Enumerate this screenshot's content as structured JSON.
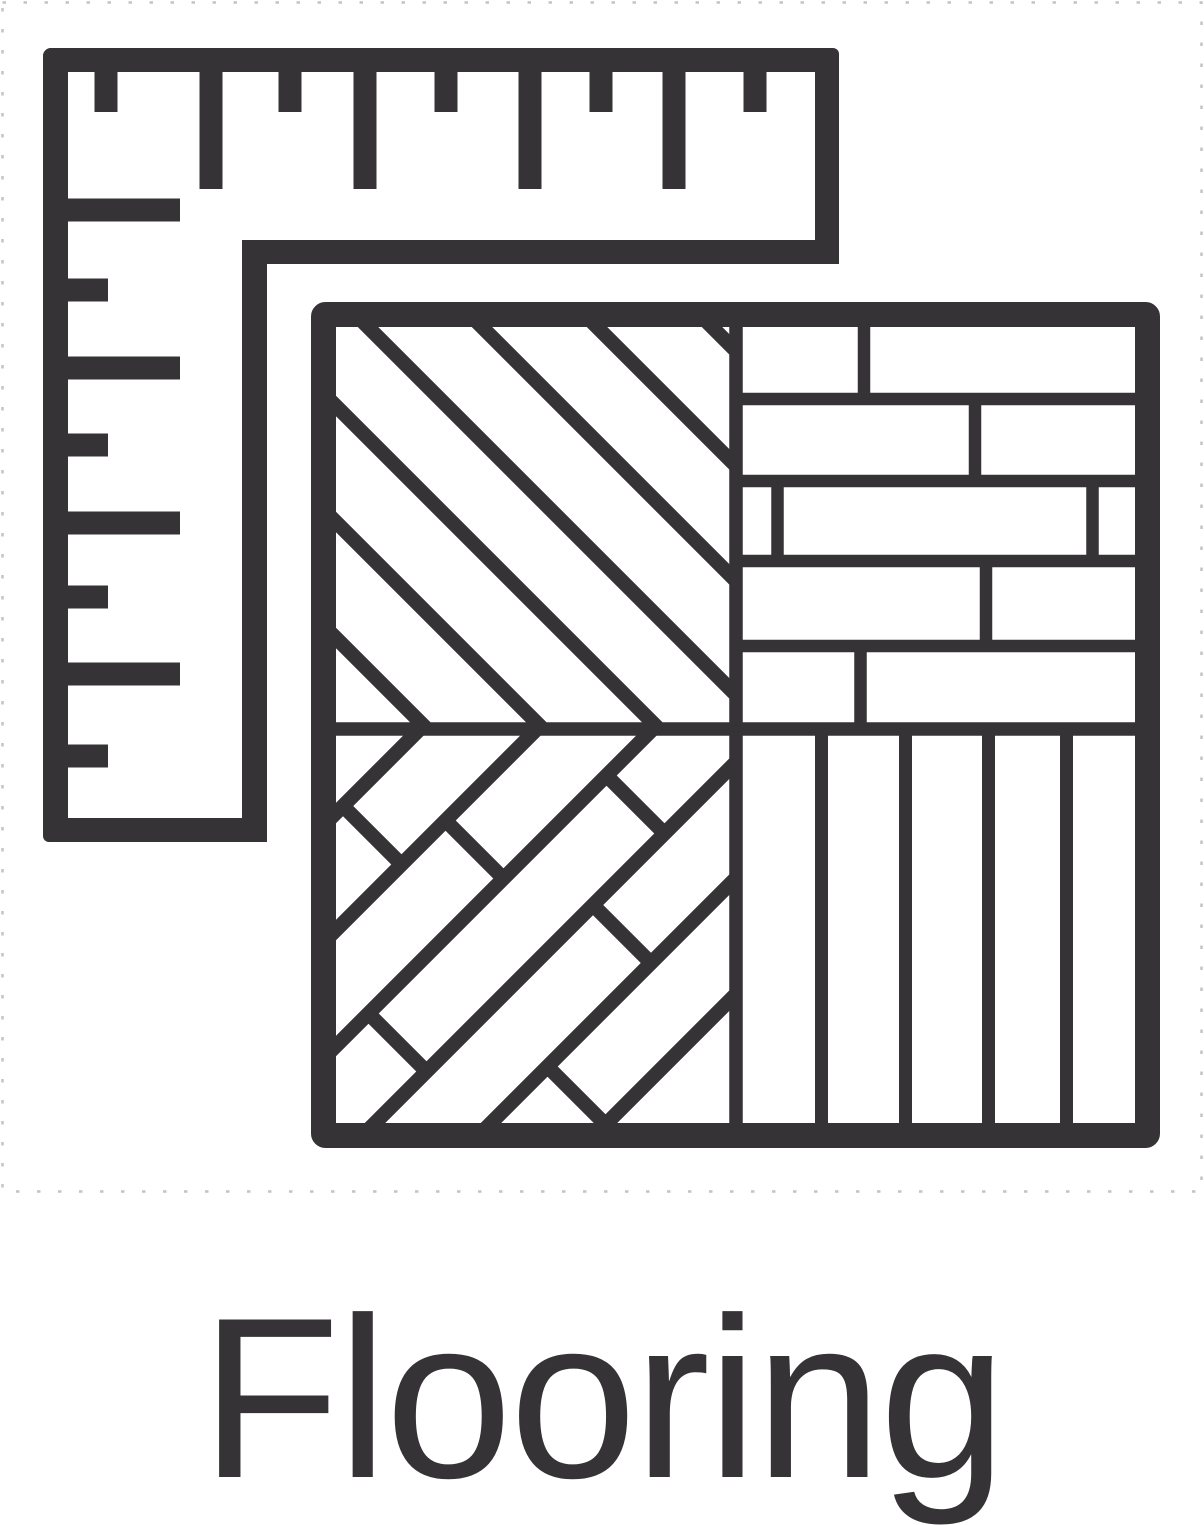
{
  "page": {
    "background_color": "#ffffff"
  },
  "icon": {
    "primary_color": "#363336",
    "canvas_border_color": "#c4c4c4",
    "tile_fill": "#ffffff",
    "parts": {
      "ruler": "carpenter-square-ruler",
      "tile": "flooring-pattern-tile",
      "quadrant_top_left": "diagonal-planks",
      "quadrant_top_right": "staggered-horizontal-planks",
      "quadrant_bottom_left": "diagonal-brick-planks",
      "quadrant_bottom_right": "vertical-planks"
    }
  },
  "caption": {
    "label": "Flooring",
    "color": "#363336"
  }
}
